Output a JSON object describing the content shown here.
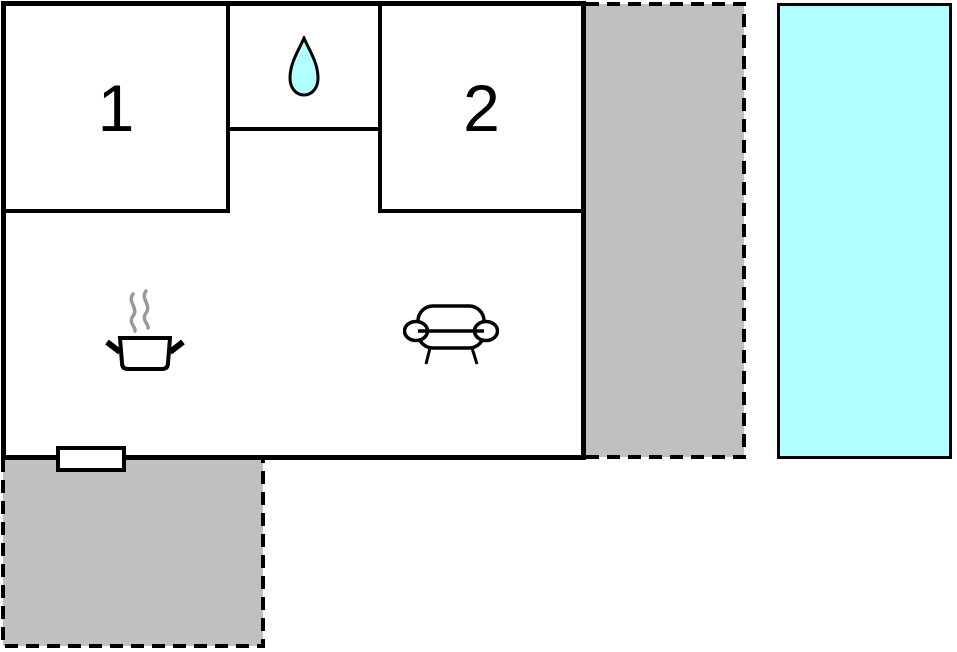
{
  "rooms": {
    "room1": {
      "label": "1"
    },
    "room2": {
      "label": "2"
    }
  },
  "icons": {
    "bathroom": "water-drop-icon",
    "kitchen": "cooking-pot-icon",
    "living_room": "sofa-icon"
  },
  "colors": {
    "wall": "#000000",
    "background": "#FFFFFF",
    "terrace_fill": "#C0C0C0",
    "pool_fill": "#B2FFFF",
    "water_drop_fill": "#B2FFFF",
    "steam": "#999999"
  }
}
